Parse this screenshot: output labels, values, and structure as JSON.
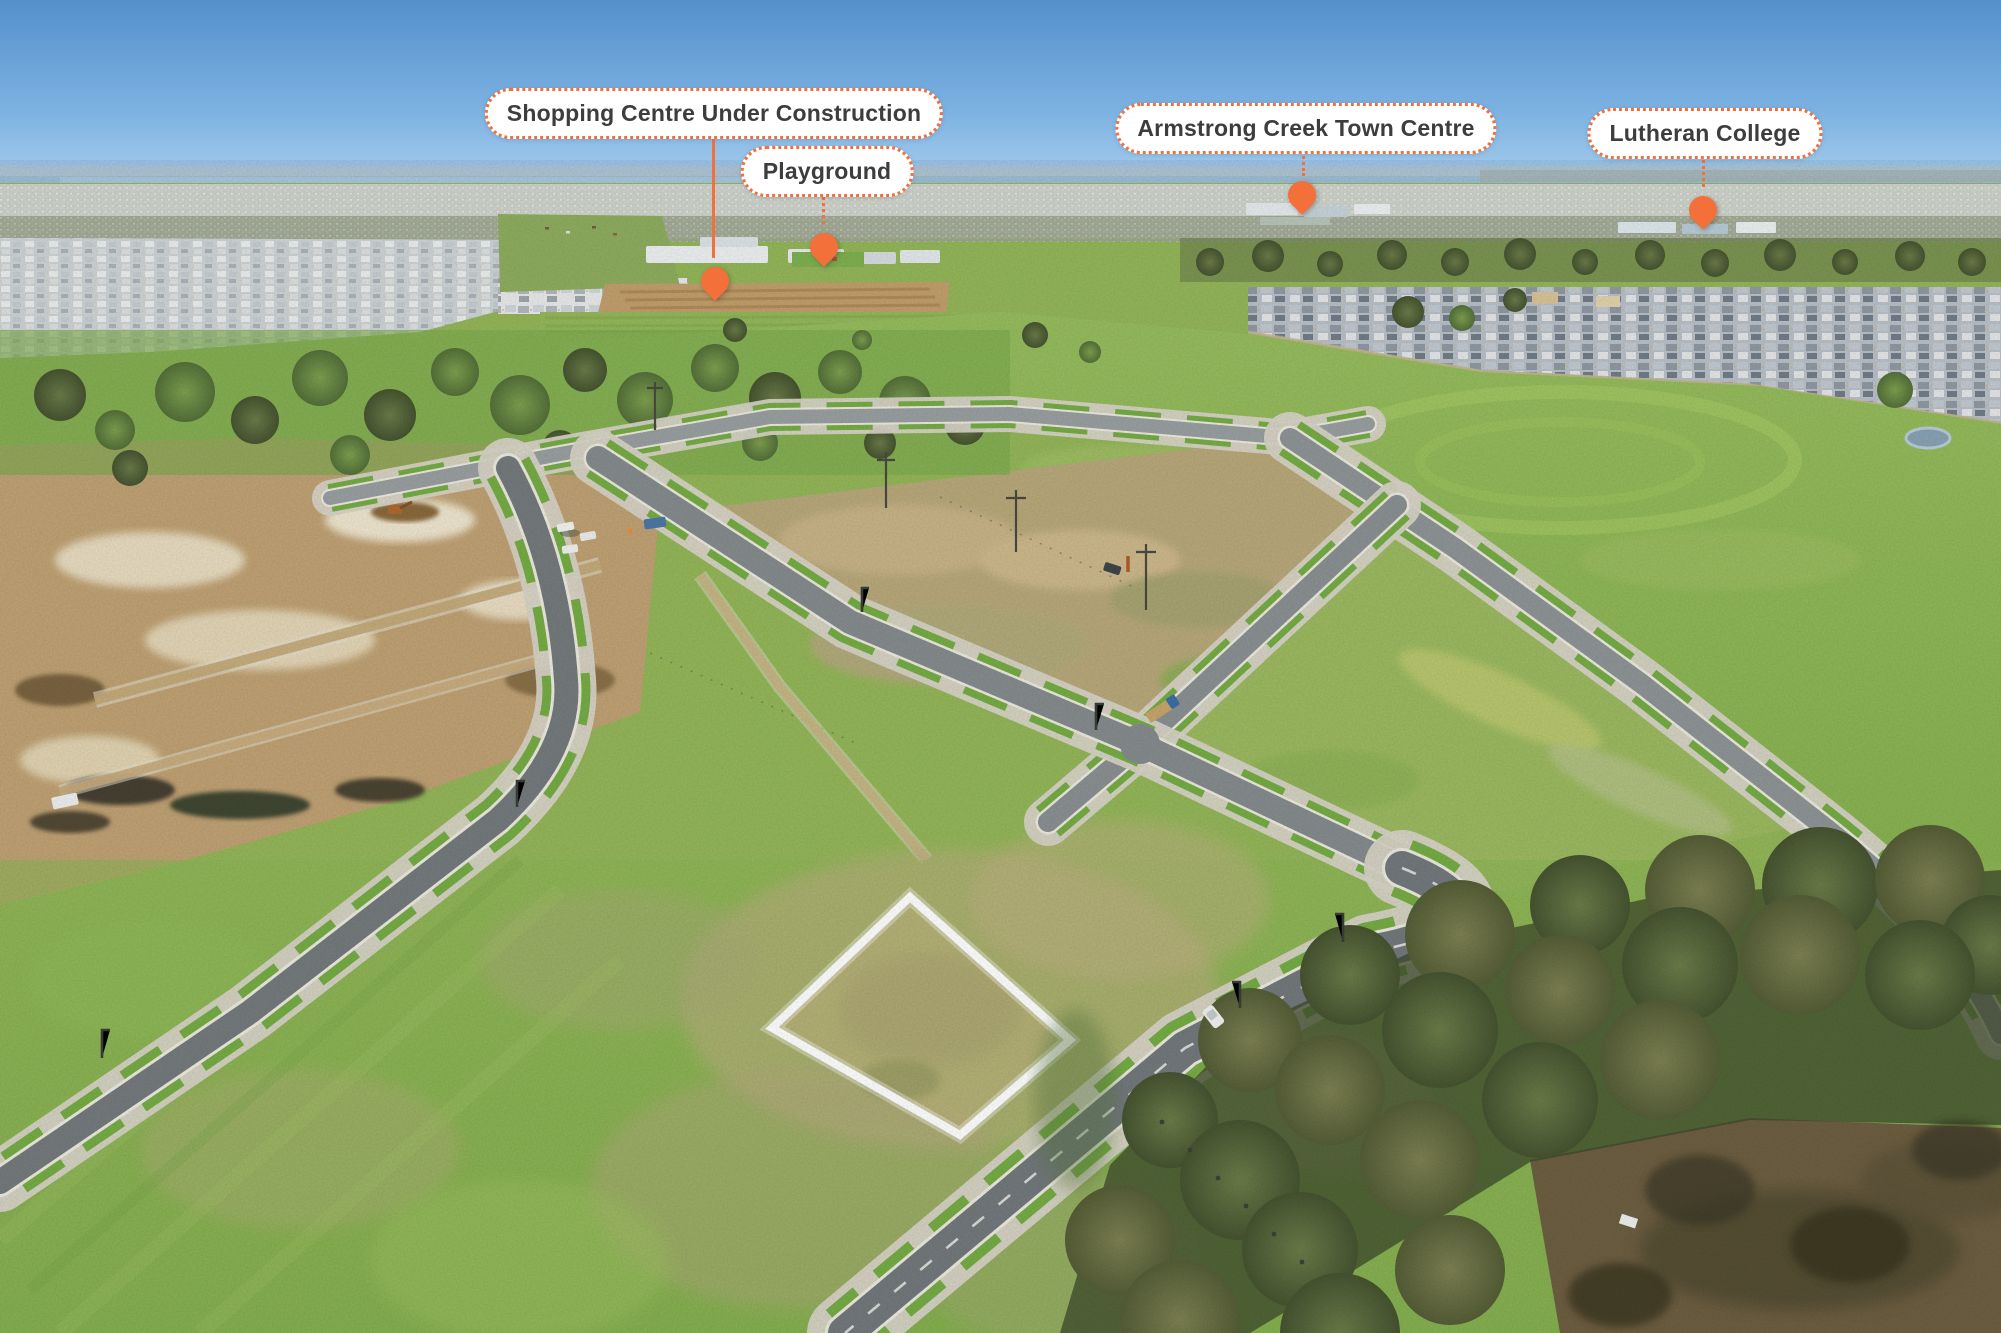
{
  "theme": {
    "accent": "#f4703b",
    "label_bg": "#ffffff",
    "label_text": "#3d3d3d",
    "sky": "#6ca9dd",
    "grass": "#8bb455",
    "dirt": "#c3a97a",
    "road": "#8a9093",
    "lot_outline": "#ffffff"
  },
  "scene": {
    "description": "Aerial drone photo of a new land estate: surveyed vacant lots and fresh roads in the foreground, earthworks on the left, established suburbs and bay on the horizon, large gum trees and a dam at lower right, with one vacant lot highlighted by a white outline.",
    "highlighted_lot_outline": "#ffffff"
  },
  "annotations": [
    {
      "id": "shopping-centre",
      "label": "Shopping Centre Under Construction",
      "pill": {
        "cx": 714,
        "top": 88
      },
      "line": {
        "x": 713,
        "y1": 138,
        "y2": 258,
        "style": "solid"
      },
      "pin": {
        "x": 715,
        "tipY": 300
      }
    },
    {
      "id": "playground",
      "label": "Playground",
      "pill": {
        "cx": 827,
        "top": 146
      },
      "line": {
        "x": 823,
        "y1": 192,
        "y2": 224,
        "style": "dotted"
      },
      "pin": {
        "x": 824,
        "tipY": 266
      }
    },
    {
      "id": "armstrong-creek-town-centre",
      "label": "Armstrong Creek Town Centre",
      "pill": {
        "cx": 1306,
        "top": 103
      },
      "line": {
        "x": 1303,
        "y1": 151,
        "y2": 176,
        "style": "dotted"
      },
      "pin": {
        "x": 1302,
        "tipY": 214
      }
    },
    {
      "id": "lutheran-college",
      "label": "Lutheran College",
      "pill": {
        "cx": 1705,
        "top": 108
      },
      "line": {
        "x": 1703,
        "y1": 155,
        "y2": 187,
        "style": "dotted"
      },
      "pin": {
        "x": 1703,
        "tipY": 229
      }
    }
  ]
}
